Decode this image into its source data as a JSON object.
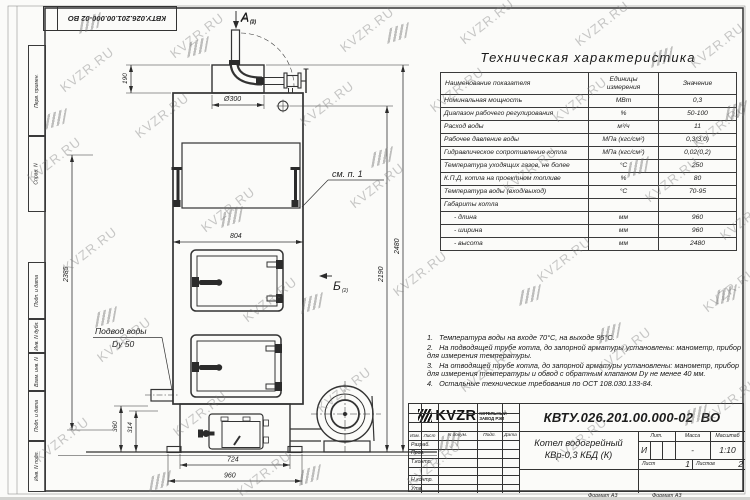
{
  "watermark": {
    "text": "KVZR.RU"
  },
  "stamp": {
    "number": "КВТУ.026.201.00.000-02 ВО"
  },
  "frame": {
    "labels": [
      "Перв. примен.",
      "Справ. N",
      "Подп. и дата",
      "Инв. N дубл.",
      "Взам. инв. N",
      "Подп. и дата",
      "Инв. N подл."
    ]
  },
  "spec_table": {
    "title": "Техническая характеристика",
    "col_name": "Наименование показателя",
    "col_units": "Единицы измерения",
    "col_value": "Значение",
    "rows": [
      {
        "name": "Номинальная мощность",
        "unit": "МВт",
        "value": "0,3"
      },
      {
        "name": "Диапазон рабочего регулирования",
        "unit": "%",
        "value": "50-100"
      },
      {
        "name": "Расход воды",
        "unit": "м³/ч",
        "value": "11"
      },
      {
        "name": "Рабочее давление воды",
        "unit": "МПа (кгс/см²)",
        "value": "0,3(3,0)"
      },
      {
        "name": "Гидравлическое сопротивление котла",
        "unit": "МПа (кгс/см²)",
        "value": "0,02(0,2)"
      },
      {
        "name": "Температура уходящих газов, не более",
        "unit": "°С",
        "value": "250"
      },
      {
        "name": "К.П.Д. котла на проектном топливе",
        "unit": "%",
        "value": "80"
      },
      {
        "name": "Температура воды (вход/выход)",
        "unit": "°С",
        "value": "70-95"
      },
      {
        "name": "Габариты котла",
        "unit": "",
        "value": ""
      },
      {
        "name": "- длина",
        "unit": "мм",
        "value": "960"
      },
      {
        "name": "- ширина",
        "unit": "мм",
        "value": "960"
      },
      {
        "name": "- высота",
        "unit": "мм",
        "value": "2480"
      }
    ]
  },
  "notes": [
    {
      "n": "1.",
      "text": "Температура воды на входе 70°С, на выходе 95°С."
    },
    {
      "n": "2.",
      "text": "На подводящей трубе котла, до запорной арматуры установлены: манометр, прибор для измерения температуры."
    },
    {
      "n": "3.",
      "text": "На отводящей трубе котла, до запорной арматуры установлены: манометр, прибор для измерения температуры и обвод с обратным клапаном Dу не менее 40 мм."
    },
    {
      "n": "4.",
      "text": "Остальные технические требования по ОСТ 108.030.133-84."
    }
  ],
  "drawing": {
    "view_a": "А",
    "view_a_sub": "(2)",
    "view_b": "Б",
    "view_b_sub": "(2)",
    "see_note": "см. п. 1",
    "water_line1": "Подвод воды",
    "water_line2": "Dy 50",
    "dims": {
      "d190": "190",
      "d300": "Ø300",
      "d804": "804",
      "d2385": "2385",
      "d2190": "2190",
      "d2480": "2480",
      "d360": "360",
      "d314": "314",
      "d724": "724",
      "d960": "960"
    }
  },
  "title_block": {
    "number": "КВТУ.026.201.00.000-02  ВО",
    "name_line1": "Котел водогрейный",
    "name_line2": "КВр-0,3 КБД (К)",
    "cols": {
      "izm": "Изм.",
      "list": "Лист",
      "ndok": "N докум.",
      "podp": "Подп.",
      "data": "Дата"
    },
    "rows": [
      "Разраб.",
      "Пров.",
      "Т.контр.",
      "",
      "Н.контр.",
      "Утв."
    ],
    "lit_h": "Лит.",
    "lit_v": "И",
    "mass_h": "Масса",
    "mass_v": "-",
    "scale_h": "Масштаб",
    "scale_v": "1:10",
    "sheet_h": "Лист",
    "sheet_v": "1",
    "sheets_h": "Листов",
    "sheets_v": "2",
    "logo": "KVZR",
    "logo_sub1": "КОТЕЛЬНЫЙ",
    "logo_sub2": "ЗАВОД РЭП",
    "format_1": "Формат А3",
    "format_2": "Формат А3"
  }
}
